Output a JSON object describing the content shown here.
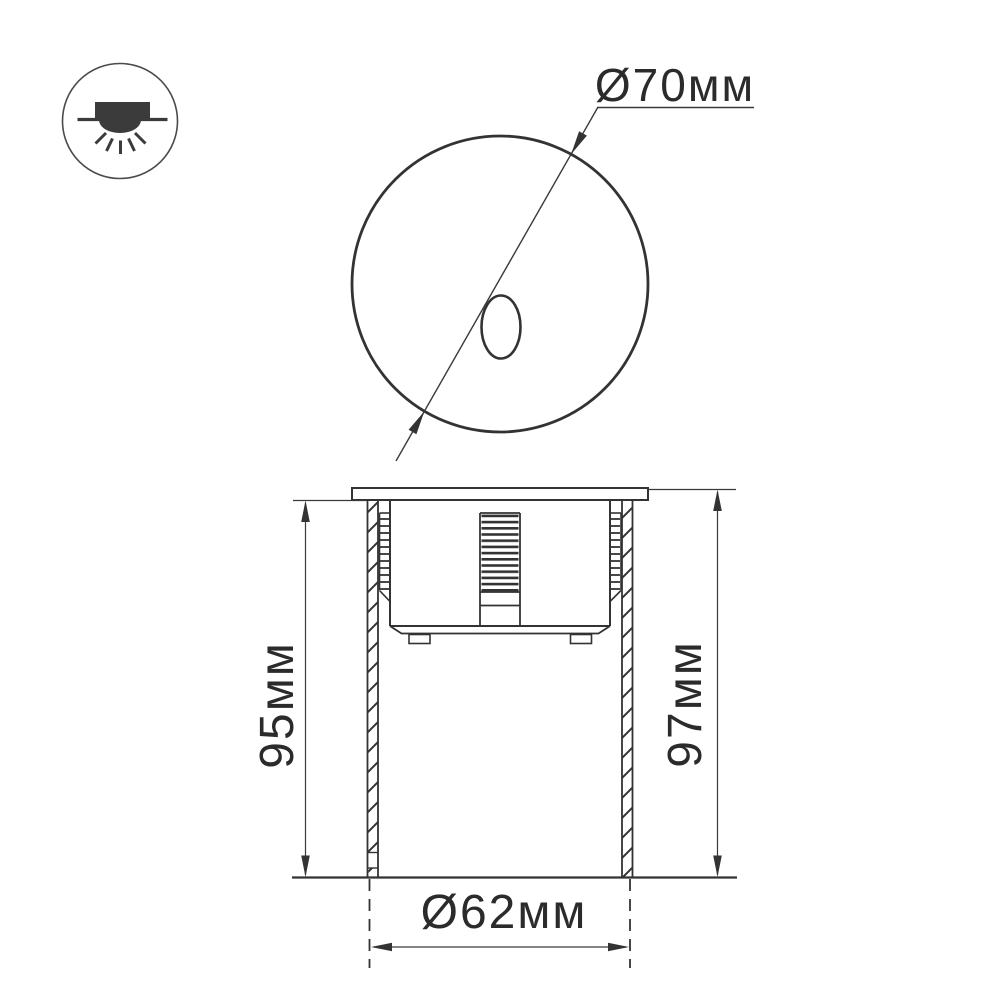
{
  "colors": {
    "background": "#ffffff",
    "line": "#333333",
    "thin_line": "#3a3a3a",
    "text": "#2b2b2b",
    "icon": "#3b3b3b"
  },
  "icon": {
    "name": "recessed-downlight-icon"
  },
  "front_view": {
    "diameter_label": "Ø70мм"
  },
  "section_view": {
    "recess_depth_label": "95мм",
    "overall_height_label": "97мм",
    "body_diameter_label": "Ø62мм"
  }
}
